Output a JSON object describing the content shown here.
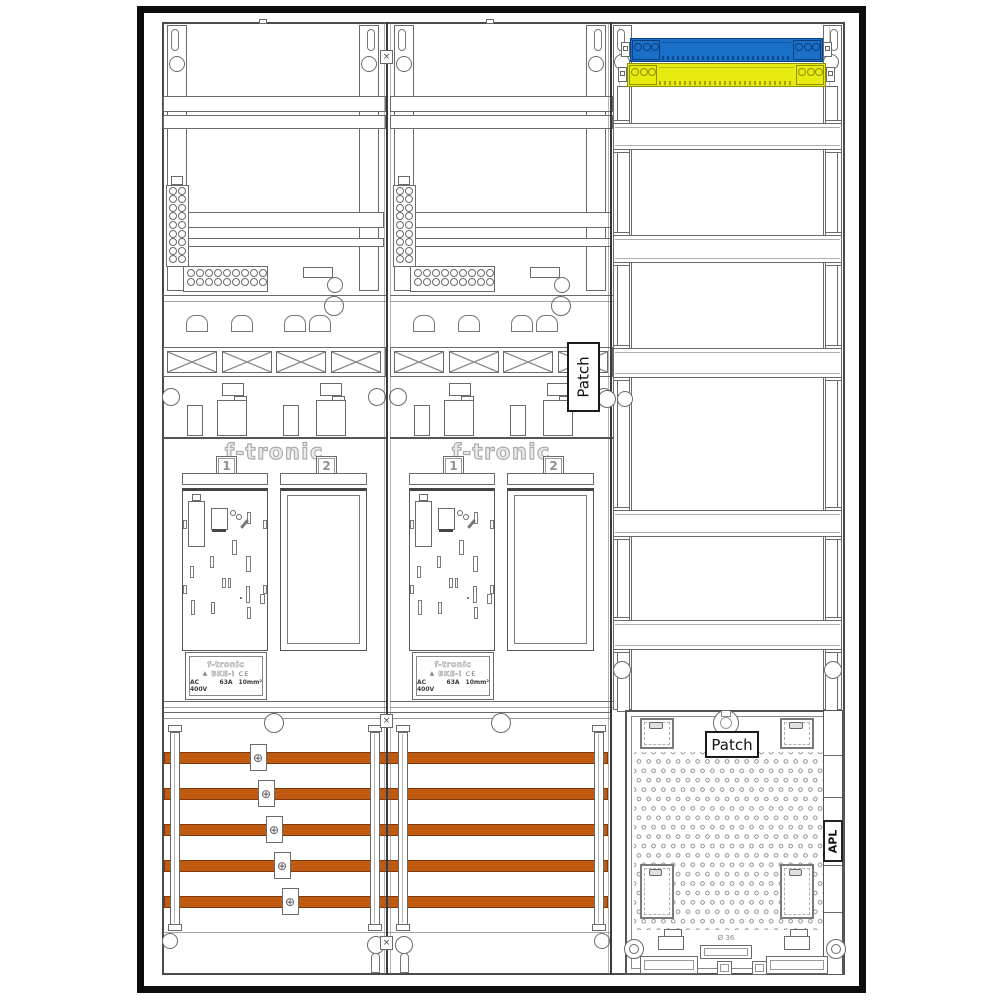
{
  "document": {
    "type": "electrical-meter-cabinet-assembly-drawing"
  },
  "colors": {
    "frame": "#0d0d0d",
    "line": "#6a6a6a",
    "n_rail_blue": "#1a6fc8",
    "n_rail_blue_dark": "#0b3f7e",
    "pe_rail_yellow": "#e8eb10",
    "pe_rail_yellow_dark": "#8f9000",
    "busbar_orange": "#c05a10",
    "busbar_orange_dark": "#7d3a08"
  },
  "icons": {
    "clamp_screw": "⊕",
    "divider_joint": "×"
  },
  "labels": {
    "patch_mid": "Patch",
    "patch_bottom": "Patch",
    "apl": "APL",
    "cable_diameter": "Ø 36"
  },
  "meter_fields": [
    {
      "brand": "f-tronic",
      "slot_numbers": [
        "1",
        "2"
      ],
      "nameplate": {
        "brand": "f-tronic",
        "logo": "▲",
        "model": "BKE-I",
        "ce": "CE",
        "rating_voltage": "AC 400V",
        "rating_current": "63A",
        "rating_section": "10mm²"
      }
    },
    {
      "brand": "f-tronic",
      "slot_numbers": [
        "1",
        "2"
      ],
      "nameplate": {
        "brand": "f-tronic",
        "logo": "▲",
        "model": "BKE-I",
        "ce": "CE",
        "rating_voltage": "AC 400V",
        "rating_current": "63A",
        "rating_section": "10mm²"
      }
    }
  ],
  "busbar_section": {
    "bar_count": 5,
    "bar_ys": [
      752,
      788,
      824,
      860,
      896
    ],
    "clamp_centers_x": [
      258,
      266,
      274,
      282,
      290
    ]
  },
  "right_field": {
    "shelf_bands": [
      [
        123,
        150
      ],
      [
        235,
        263
      ],
      [
        348,
        378
      ],
      [
        510,
        537
      ],
      [
        620,
        650
      ]
    ]
  }
}
